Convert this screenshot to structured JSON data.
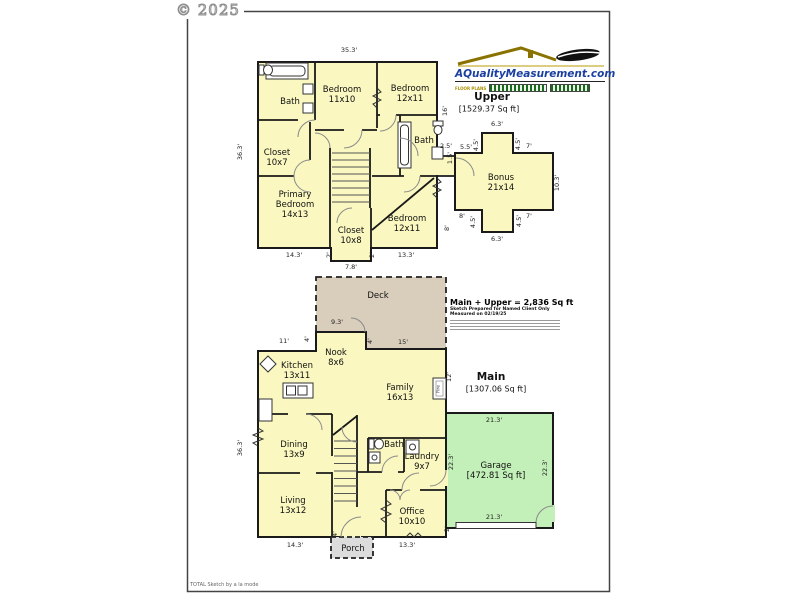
{
  "page": {
    "copyright": "© 2025",
    "footer": "TOTAL Sketch by a la mode"
  },
  "logo": {
    "site": "AQualityMeasurement.com",
    "tagline": "FLOOR PLANS"
  },
  "summary": {
    "total": "Main + Upper = 2,836 Sq ft",
    "prepared": "Sketch Prepared for Named Client Only",
    "measured": "Measured on 02/19/25"
  },
  "floors": {
    "upper": {
      "name": "Upper",
      "area": "[1529.37 Sq ft]"
    },
    "main": {
      "name": "Main",
      "area": "[1307.06 Sq ft]"
    },
    "garage": {
      "name": "Garage",
      "area": "[472.81 Sq ft]"
    }
  },
  "colors": {
    "room_fill": "#FAF8C0",
    "deck_fill": "#D9CEBC",
    "garage_fill": "#C3EFB8",
    "porch_fill": "#DCDCDC",
    "logo_blue": "#1B3FA0"
  },
  "labels": [
    {
      "cls": "hdr",
      "lines": [
        "Upper"
      ],
      "x": 492,
      "y": 97
    },
    {
      "cls": "area",
      "lines": [
        "[1529.37 Sq ft]"
      ],
      "x": 489,
      "y": 109
    },
    {
      "cls": "room",
      "lines": [
        "Bath"
      ],
      "x": 290,
      "y": 102
    },
    {
      "cls": "room",
      "lines": [
        "Bedroom",
        "11x10"
      ],
      "x": 342,
      "y": 95
    },
    {
      "cls": "room",
      "lines": [
        "Bedroom",
        "12x11"
      ],
      "x": 410,
      "y": 94
    },
    {
      "cls": "room",
      "lines": [
        "Bath"
      ],
      "x": 424,
      "y": 141
    },
    {
      "cls": "room",
      "lines": [
        "Closet",
        "10x7"
      ],
      "x": 277,
      "y": 158
    },
    {
      "cls": "room",
      "lines": [
        "Primary",
        "Bedroom",
        "14x13"
      ],
      "x": 295,
      "y": 205
    },
    {
      "cls": "room",
      "lines": [
        "Closet",
        "10x8"
      ],
      "x": 351,
      "y": 236
    },
    {
      "cls": "room",
      "lines": [
        "Bedroom",
        "12x11"
      ],
      "x": 407,
      "y": 224
    },
    {
      "cls": "room",
      "lines": [
        "Bonus",
        "21x14"
      ],
      "x": 501,
      "y": 183
    },
    {
      "cls": "room",
      "lines": [
        "Deck"
      ],
      "x": 378,
      "y": 296
    },
    {
      "cls": "room",
      "lines": [
        "Nook",
        "8x6"
      ],
      "x": 336,
      "y": 358
    },
    {
      "cls": "room",
      "lines": [
        "Kitchen",
        "13x11"
      ],
      "x": 297,
      "y": 371
    },
    {
      "cls": "room",
      "lines": [
        "Family",
        "16x13"
      ],
      "x": 400,
      "y": 393
    },
    {
      "cls": "room",
      "lines": [
        "Dining",
        "13x9"
      ],
      "x": 294,
      "y": 450
    },
    {
      "cls": "room",
      "lines": [
        "Living",
        "13x12"
      ],
      "x": 293,
      "y": 506
    },
    {
      "cls": "room",
      "lines": [
        "Bath"
      ],
      "x": 394,
      "y": 445
    },
    {
      "cls": "room",
      "lines": [
        "Laundry",
        "9x7"
      ],
      "x": 422,
      "y": 462
    },
    {
      "cls": "room",
      "lines": [
        "Office",
        "10x10"
      ],
      "x": 412,
      "y": 517
    },
    {
      "cls": "room",
      "lines": [
        "Porch"
      ],
      "x": 353,
      "y": 549
    },
    {
      "cls": "room",
      "lines": [
        "Garage",
        "[472.81 Sq ft]"
      ],
      "x": 496,
      "y": 471
    },
    {
      "cls": "hdr",
      "lines": [
        "Main"
      ],
      "x": 491,
      "y": 377
    },
    {
      "cls": "area",
      "lines": [
        "[1307.06 Sq ft]"
      ],
      "x": 496,
      "y": 389
    },
    {
      "cls": "tiny",
      "lines": [
        "Fire"
      ],
      "x": 439,
      "y": 389,
      "rot": -90
    }
  ],
  "dims": [
    {
      "text": "35.3'",
      "x": 349,
      "y": 51
    },
    {
      "text": "36.3'",
      "x": 241,
      "y": 152,
      "rot": -90
    },
    {
      "text": "16'",
      "x": 446,
      "y": 111,
      "rot": -90
    },
    {
      "text": "2.5'",
      "x": 446,
      "y": 147
    },
    {
      "text": "1.5'",
      "x": 451,
      "y": 158,
      "rot": -90
    },
    {
      "text": "5.5'",
      "x": 466,
      "y": 148
    },
    {
      "text": "4.5'",
      "x": 477,
      "y": 145,
      "rot": -90
    },
    {
      "text": "6.3'",
      "x": 497,
      "y": 125
    },
    {
      "text": "4.5'",
      "x": 519,
      "y": 144,
      "rot": -90
    },
    {
      "text": "7'",
      "x": 529,
      "y": 147
    },
    {
      "text": "10.3'",
      "x": 558,
      "y": 183,
      "rot": -90
    },
    {
      "text": "7'",
      "x": 529,
      "y": 217
    },
    {
      "text": "4.5'",
      "x": 520,
      "y": 221,
      "rot": -90
    },
    {
      "text": "6.3'",
      "x": 497,
      "y": 240
    },
    {
      "text": "4.5'",
      "x": 474,
      "y": 222,
      "rot": -90
    },
    {
      "text": "8'",
      "x": 462,
      "y": 217
    },
    {
      "text": "8'",
      "x": 448,
      "y": 228,
      "rot": -90
    },
    {
      "text": "14.3'",
      "x": 294,
      "y": 256
    },
    {
      "text": "2'",
      "x": 330,
      "y": 255,
      "rot": -90
    },
    {
      "text": "7.8'",
      "x": 351,
      "y": 268
    },
    {
      "text": "2'",
      "x": 373,
      "y": 255,
      "rot": -90
    },
    {
      "text": "13.3'",
      "x": 406,
      "y": 256
    },
    {
      "text": "11'",
      "x": 284,
      "y": 342
    },
    {
      "text": "4'",
      "x": 308,
      "y": 339,
      "rot": -90
    },
    {
      "text": "9.3'",
      "x": 337,
      "y": 323
    },
    {
      "text": "4'",
      "x": 371,
      "y": 341,
      "rot": -90
    },
    {
      "text": "15'",
      "x": 403,
      "y": 343
    },
    {
      "text": "36.3'",
      "x": 241,
      "y": 448,
      "rot": -90
    },
    {
      "text": "12'",
      "x": 450,
      "y": 377,
      "rot": -90
    },
    {
      "text": "21.3'",
      "x": 494,
      "y": 421
    },
    {
      "text": "22.3'",
      "x": 452,
      "y": 462,
      "rot": -90
    },
    {
      "text": "22.3'",
      "x": 546,
      "y": 468,
      "rot": -90
    },
    {
      "text": "21.3'",
      "x": 494,
      "y": 518
    },
    {
      "text": "2'",
      "x": 448,
      "y": 529,
      "rot": -90
    },
    {
      "text": "14.3'",
      "x": 295,
      "y": 546
    },
    {
      "text": "4'",
      "x": 336,
      "y": 534,
      "rot": -90
    },
    {
      "text": "13.3'",
      "x": 407,
      "y": 546
    }
  ]
}
